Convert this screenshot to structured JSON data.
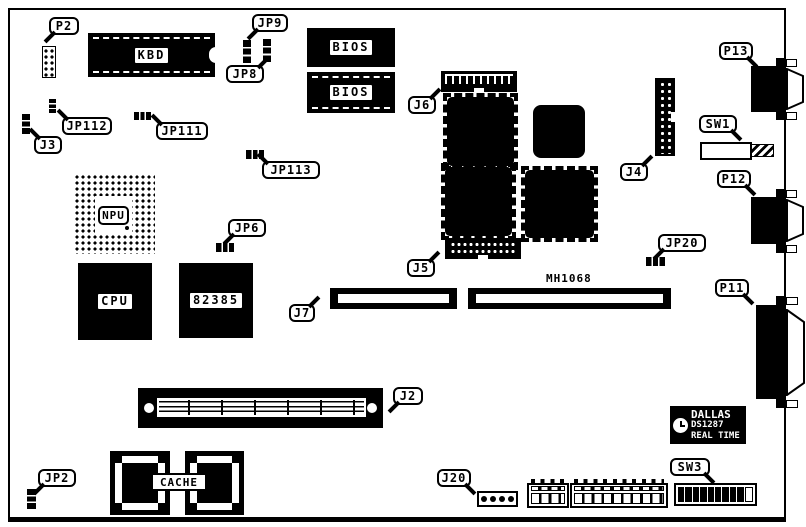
{
  "callouts": {
    "p2": "P2",
    "jp9": "JP9",
    "jp8": "JP8",
    "j3": "J3",
    "jp112": "JP112",
    "jp111": "JP111",
    "jp113": "JP113",
    "j6": "J6",
    "jp6": "JP6",
    "j4": "J4",
    "j5": "J5",
    "j7": "J7",
    "jp20": "JP20",
    "p13": "P13",
    "sw1": "SW1",
    "p12": "P12",
    "p11": "P11",
    "j2": "J2",
    "jp2": "JP2",
    "j20": "J20",
    "sw3": "SW3"
  },
  "chips": {
    "kbd": "KBD",
    "bios_top": "BIOS",
    "bios_bottom": "BIOS",
    "npu": "NPU",
    "cpu": "CPU",
    "cache_controller": "82385",
    "cache": "CACHE",
    "bus": "MH1068"
  },
  "rtc": {
    "brand": "DALLAS",
    "part": "DS1287",
    "type": "REAL TIME"
  }
}
